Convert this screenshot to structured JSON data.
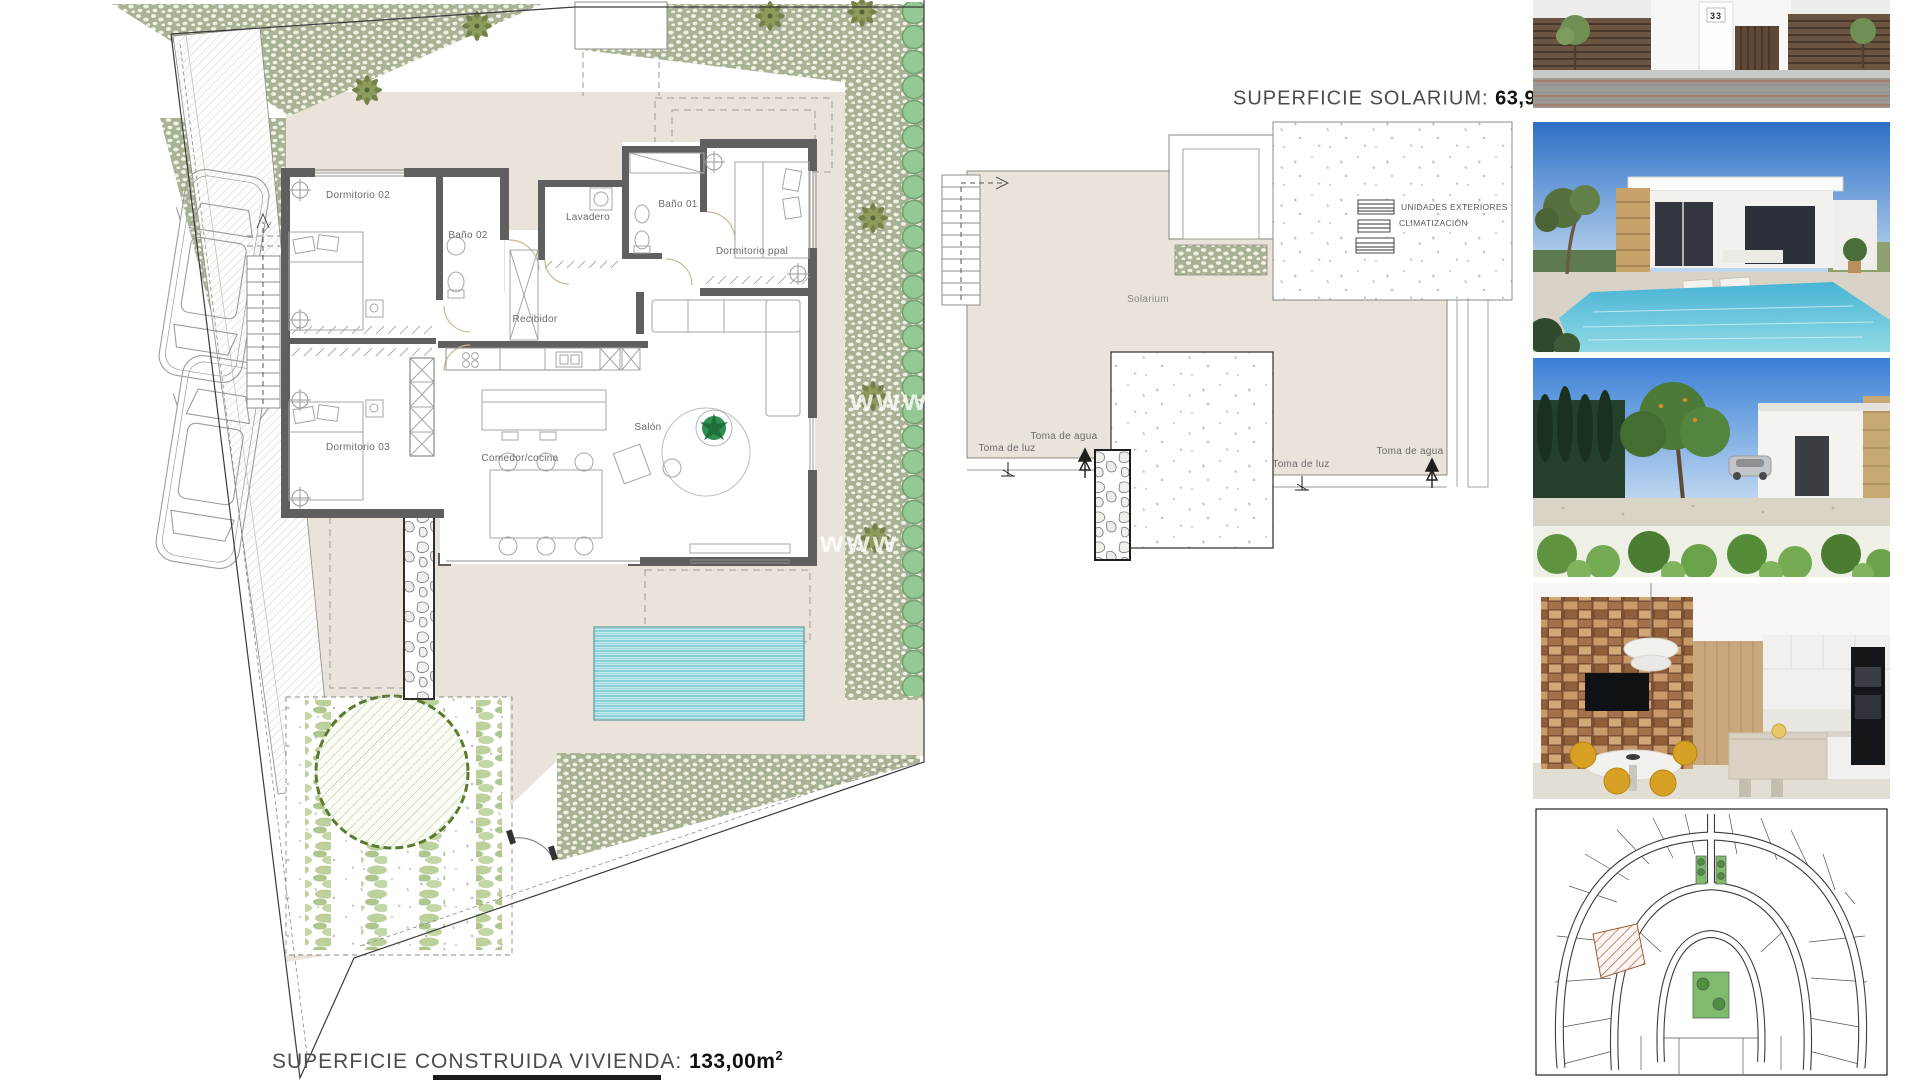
{
  "floor_plan": {
    "rooms": {
      "dormitorio02": "Dormitorio 02",
      "bano02": "Baño 02",
      "lavadero": "Lavadero",
      "bano01": "Baño 01",
      "dormitorio_ppal": "Dormitorio ppal",
      "recibidor": "Recibidor",
      "dormitorio03": "Dormitorio 03",
      "comedor_cocina": "Comedor/cocina",
      "salon": "Salón"
    },
    "surface": {
      "label": "SUPERFICIE CONSTRUIDA VIVIENDA:",
      "value": "133,00m",
      "sup": "2"
    },
    "watermark": "www"
  },
  "solarium_plan": {
    "surface": {
      "label": "SUPERFICIE SOLARIUM:",
      "value": "63,94m",
      "sup": "2"
    },
    "area_label": "Solarium",
    "ac_label_line1": "UNIDADES EXTERIORES",
    "ac_label_line2": "CLIMATIZACIÓN",
    "left_connections": {
      "water": "Toma de agua",
      "light": "Toma de luz"
    },
    "right_connections": {
      "water": "Toma de agua",
      "light": "Toma de luz"
    }
  },
  "photos": {
    "street": {
      "house_number": "33"
    }
  },
  "colors": {
    "terrace_beige": "#e9e3d9",
    "landscape_green": "#a8b295",
    "bush_green": "#94c894",
    "pool_cyan": "#57bdc8",
    "wall_gray": "#5f5f5f",
    "stone_tan": "#c8a369",
    "chair_yellow": "#d7a125",
    "plot_hatch_red": "#b5745a"
  }
}
